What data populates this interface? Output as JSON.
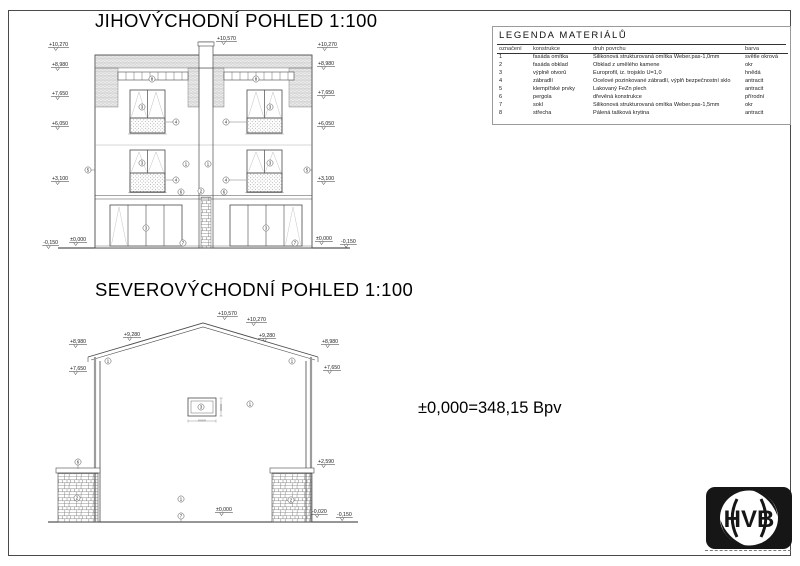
{
  "titles": {
    "elevation1": "JIHOVÝCHODNÍ POHLED 1:100",
    "elevation2": "SEVEROVÝCHODNÍ POHLED 1:100"
  },
  "datum_note": "±0,000=348,15 Bpv",
  "logo": {
    "text": "HVB"
  },
  "tags": {
    "t1": "1",
    "t2": "2",
    "t3": "3",
    "t4": "4",
    "t5": "5",
    "t6": "6",
    "t7": "7",
    "t8": "8"
  },
  "elevation1": {
    "dims": {
      "top": "+10,570",
      "l1": "+10,270",
      "l2": "+8,980",
      "l3": "+7,650",
      "l4": "+6,050",
      "l5": "+3,100",
      "l6": "-0,150",
      "l7": "±0,000",
      "r1": "+10,270",
      "r2": "+8,980",
      "r3": "+7,650",
      "r4": "+6,050",
      "r5": "+3,100",
      "r6": "±0,000",
      "r7": "-0,150"
    }
  },
  "elevation2": {
    "dims": {
      "peak": "+10,570",
      "ridge": "+10,270",
      "slope_l": "+9,280",
      "slope_r": "+9,280",
      "eave_l": "+8,980",
      "eave_r": "+8,980",
      "wall_l": "+7,650",
      "wall_r": "+7,650",
      "pillar": "+2,590",
      "ground": "±0,000",
      "ground2": "-0,020",
      "ground3": "-0,150"
    }
  },
  "legend": {
    "title": "LEGENDA MATERIÁLŮ",
    "headers": [
      "označení",
      "konstrukce",
      "druh povrchu",
      "barva"
    ],
    "rows": [
      {
        "id": "1",
        "konstrukce": "fasáda omítka",
        "povrch": "Silikonová strukturovaná omítka Weber.pas-1,0mm",
        "barva": "světle okrová"
      },
      {
        "id": "2",
        "konstrukce": "fasáda obklad",
        "povrch": "Obklad z umělého kamene",
        "barva": "okr"
      },
      {
        "id": "3",
        "konstrukce": "výplně otvorů",
        "povrch": "Europrofil, iz. trojsklo U=1,0",
        "barva": "hnědá"
      },
      {
        "id": "4",
        "konstrukce": "zábradlí",
        "povrch": "Ocelové pozinkované zábradlí, výplň bezpečnostní sklo",
        "barva": "antracit"
      },
      {
        "id": "5",
        "konstrukce": "klempířské prvky",
        "povrch": "Lakovaný FeZn plech",
        "barva": "antracit"
      },
      {
        "id": "6",
        "konstrukce": "pergola",
        "povrch": "dřevěná konstrukce",
        "barva": "přírodní"
      },
      {
        "id": "7",
        "konstrukce": "sokl",
        "povrch": "Silikonová strukturovaná omítka Weber.pas-1,5mm",
        "barva": "okr"
      },
      {
        "id": "8",
        "konstrukce": "střecha",
        "povrch": "Pálená tašková krytina",
        "barva": "antracit"
      }
    ]
  }
}
